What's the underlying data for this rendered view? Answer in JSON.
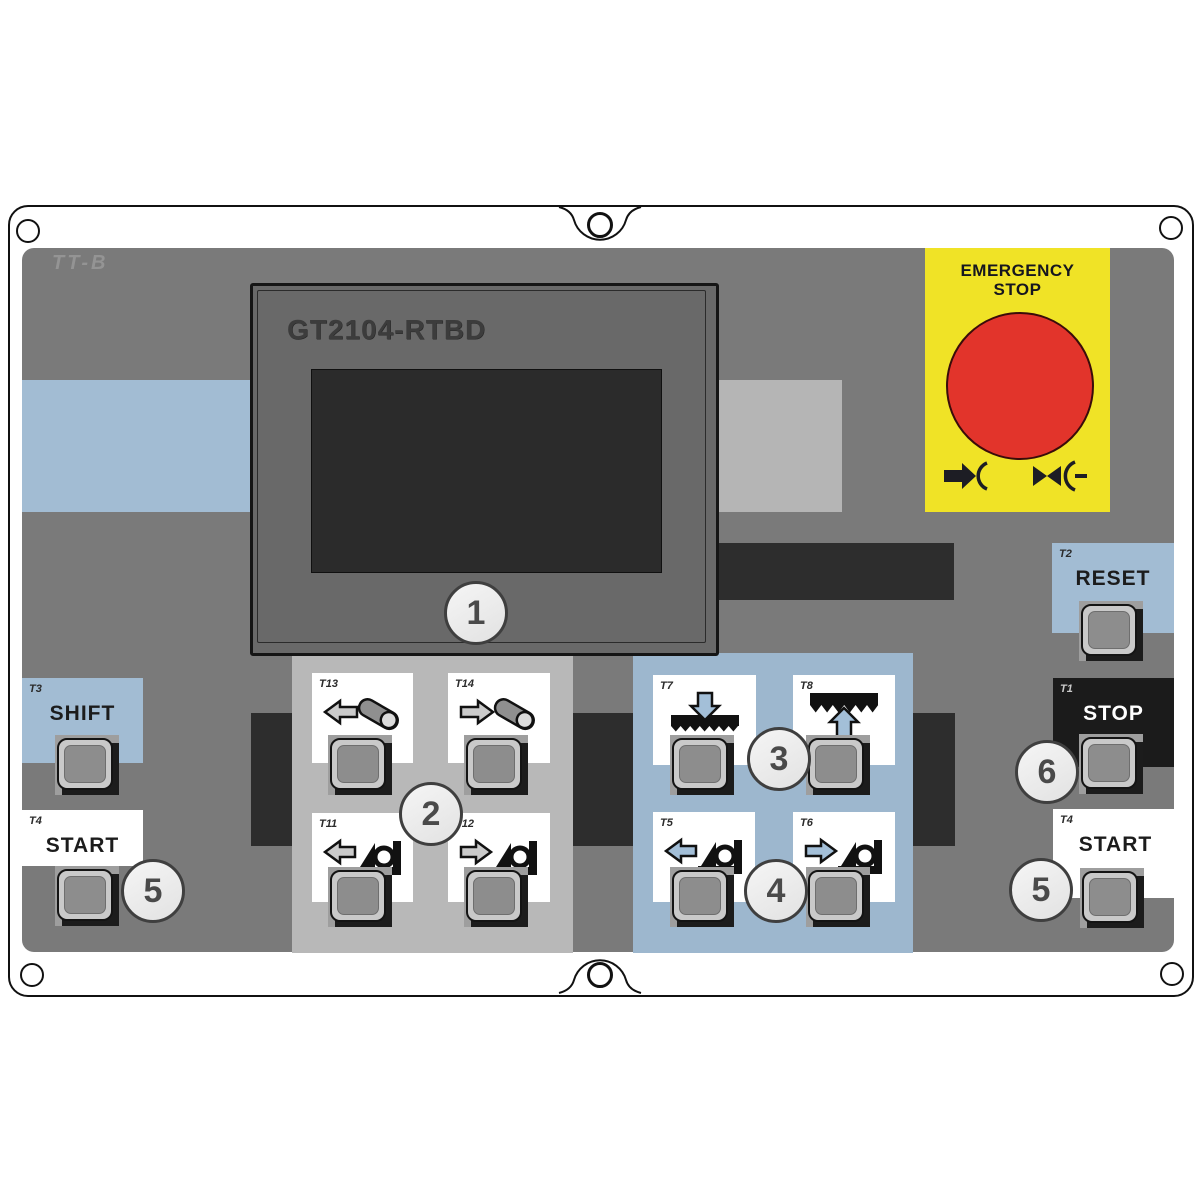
{
  "brand": "TT-B",
  "display": {
    "model": "GT2104-RTBD"
  },
  "emergency_stop": {
    "line1": "EMERGENCY",
    "line2": "STOP"
  },
  "callouts": {
    "c1": "1",
    "c2": "2",
    "c3": "3",
    "c4": "4",
    "c5": "5",
    "c6": "6"
  },
  "controls": {
    "shift": {
      "tag": "T3",
      "label": "SHIFT"
    },
    "start_left": {
      "tag": "T4",
      "label": "START"
    },
    "reset": {
      "tag": "T2",
      "label": "RESET"
    },
    "stop": {
      "tag": "T1",
      "label": "STOP"
    },
    "start_right": {
      "tag": "T4",
      "label": "START"
    }
  },
  "group2": {
    "keys": [
      {
        "tag": "T13",
        "icon": "roller-shift-left"
      },
      {
        "tag": "T14",
        "icon": "roller-shift-right"
      },
      {
        "tag": "T11",
        "icon": "guide-traverse-left"
      },
      {
        "tag": "T12",
        "icon": "guide-traverse-right"
      }
    ]
  },
  "group34": {
    "keys": [
      {
        "tag": "T7",
        "icon": "blade-down"
      },
      {
        "tag": "T8",
        "icon": "blade-up"
      },
      {
        "tag": "T5",
        "icon": "fence-left"
      },
      {
        "tag": "T6",
        "icon": "fence-right"
      }
    ]
  },
  "colors": {
    "panel_gray": "#7a7a7a",
    "accent_blue": "#a2bcd3",
    "group_blue": "#9db7ce",
    "group_gray": "#b8b8b8",
    "estop_yellow": "#f0e326",
    "estop_red": "#e2342b",
    "band_dark": "#2d2d2d"
  }
}
